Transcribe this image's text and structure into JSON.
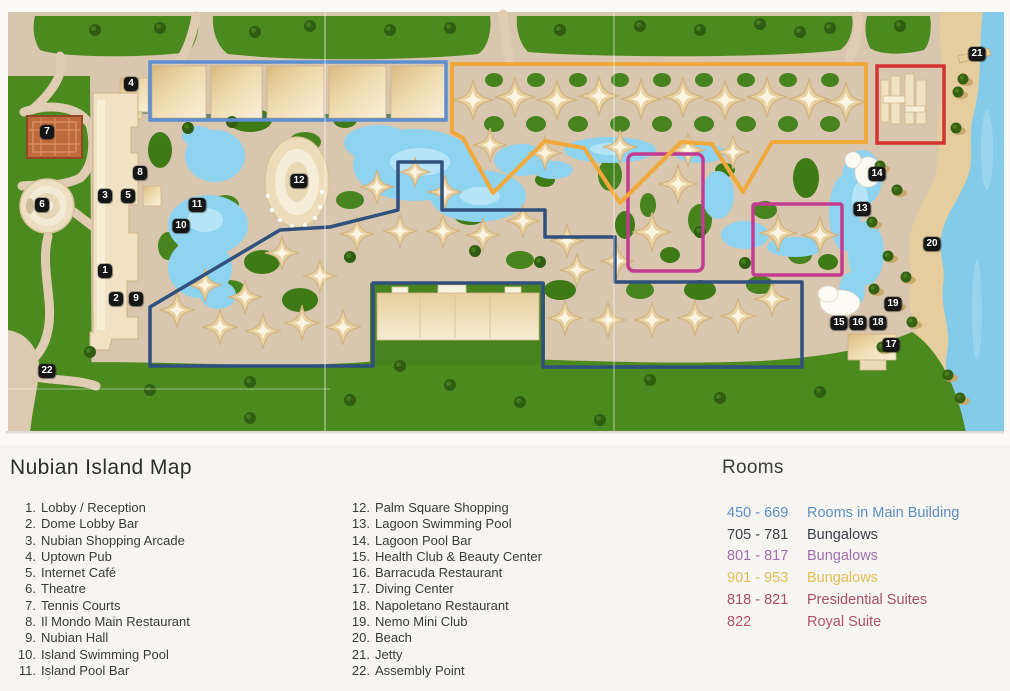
{
  "legend": {
    "title": "Nubian Island Map",
    "columns": [
      [
        {
          "num": "1",
          "label": "Lobby / Reception"
        },
        {
          "num": "2",
          "label": "Dome Lobby Bar"
        },
        {
          "num": "3",
          "label": "Nubian Shopping Arcade"
        },
        {
          "num": "4",
          "label": "Uptown Pub"
        },
        {
          "num": "5",
          "label": "Internet Café"
        },
        {
          "num": "6",
          "label": "Theatre"
        },
        {
          "num": "7",
          "label": "Tennis Courts"
        },
        {
          "num": "8",
          "label": "Il Mondo Main Restaurant"
        },
        {
          "num": "9",
          "label": "Nubian Hall"
        },
        {
          "num": "10",
          "label": "Island Swimming Pool"
        },
        {
          "num": "11",
          "label": "Island Pool Bar"
        }
      ],
      [
        {
          "num": "12",
          "label": "Palm Square Shopping"
        },
        {
          "num": "13",
          "label": "Lagoon Swimming Pool"
        },
        {
          "num": "14",
          "label": "Lagoon Pool Bar"
        },
        {
          "num": "15",
          "label": "Health Club & Beauty Center"
        },
        {
          "num": "16",
          "label": "Barracuda Restaurant"
        },
        {
          "num": "17",
          "label": "Diving Center"
        },
        {
          "num": "18",
          "label": "Napoletano Restaurant"
        },
        {
          "num": "19",
          "label": "Nemo Mini Club"
        },
        {
          "num": "20",
          "label": "Beach"
        },
        {
          "num": "21",
          "label": "Jetty"
        },
        {
          "num": "22",
          "label": "Assembly Point"
        }
      ]
    ]
  },
  "rooms": {
    "title": "Rooms",
    "entries": [
      {
        "range": "450 - 669",
        "label": "Rooms in Main Building",
        "color": "#5a8fc0"
      },
      {
        "range": "705 - 781",
        "label": "Bungalows",
        "color": "#3a3f48"
      },
      {
        "range": "801 - 817",
        "label": "Bungalows",
        "color": "#a06fae"
      },
      {
        "range": "901 - 953",
        "label": "Bungalows",
        "color": "#e0bf55"
      },
      {
        "range": "818 - 821",
        "label": "Presidential  Suites",
        "color": "#a84f63"
      },
      {
        "range": "822",
        "label": "Royal Suite",
        "color": "#b2516a"
      }
    ]
  },
  "map": {
    "overlays": [
      {
        "name": "rooms-450-669-main-building-outline",
        "color": "#5c8ed0"
      },
      {
        "name": "bungalows-705-781-outline",
        "color": "#30507e"
      },
      {
        "name": "bungalows-801-817-outline-a",
        "color": "#c23d92"
      },
      {
        "name": "bungalows-801-817-outline-b",
        "color": "#c23d92"
      },
      {
        "name": "bungalows-901-953-outline",
        "color": "#f2a93b"
      },
      {
        "name": "suites-818-822-outline",
        "color": "#d23330"
      }
    ],
    "markers": [
      {
        "n": "1",
        "x": 105,
        "y": 271,
        "label": "Lobby / Reception"
      },
      {
        "n": "2",
        "x": 116,
        "y": 299,
        "label": "Dome Lobby Bar"
      },
      {
        "n": "3",
        "x": 105,
        "y": 196,
        "label": "Nubian Shopping Arcade"
      },
      {
        "n": "4",
        "x": 131,
        "y": 84,
        "label": "Uptown Pub"
      },
      {
        "n": "5",
        "x": 128,
        "y": 196,
        "label": "Internet Café"
      },
      {
        "n": "6",
        "x": 42,
        "y": 205,
        "label": "Theatre"
      },
      {
        "n": "7",
        "x": 47,
        "y": 132,
        "label": "Tennis Courts"
      },
      {
        "n": "8",
        "x": 140,
        "y": 173,
        "label": "Il Mondo Main Restaurant"
      },
      {
        "n": "9",
        "x": 136,
        "y": 299,
        "label": "Nubian Hall"
      },
      {
        "n": "10",
        "x": 181,
        "y": 226,
        "label": "Island Swimming Pool"
      },
      {
        "n": "11",
        "x": 197,
        "y": 205,
        "label": "Island Pool Bar"
      },
      {
        "n": "12",
        "x": 299,
        "y": 181,
        "label": "Palm Square Shopping"
      },
      {
        "n": "13",
        "x": 862,
        "y": 209,
        "label": "Lagoon Swimming Pool"
      },
      {
        "n": "14",
        "x": 877,
        "y": 174,
        "label": "Lagoon Pool Bar"
      },
      {
        "n": "15",
        "x": 839,
        "y": 323,
        "label": "Health Club & Beauty Center"
      },
      {
        "n": "16",
        "x": 858,
        "y": 323,
        "label": "Barracuda Restaurant"
      },
      {
        "n": "17",
        "x": 891,
        "y": 345,
        "label": "Diving Center"
      },
      {
        "n": "18",
        "x": 878,
        "y": 323,
        "label": "Napoletano Restaurant"
      },
      {
        "n": "19",
        "x": 893,
        "y": 304,
        "label": "Nemo Mini Club"
      },
      {
        "n": "20",
        "x": 932,
        "y": 244,
        "label": "Beach"
      },
      {
        "n": "21",
        "x": 977,
        "y": 54,
        "label": "Jetty"
      },
      {
        "n": "22",
        "x": 47,
        "y": 371,
        "label": "Assembly Point"
      }
    ]
  }
}
